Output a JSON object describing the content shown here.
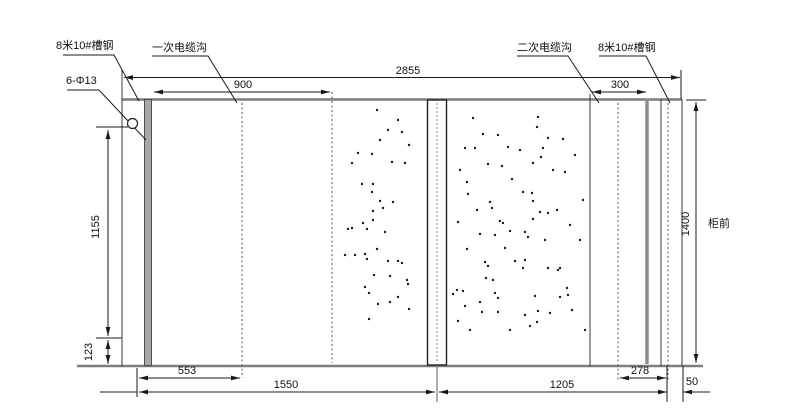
{
  "drawing": {
    "callouts": {
      "left_channel": "8米10#槽钢",
      "primary_cable_trench": "一次电缆沟",
      "secondary_cable_trench": "二次电缆沟",
      "right_channel": "8米10#槽钢",
      "bolt_holes": "6-Φ13",
      "cabinet_front": "柜前"
    },
    "dimensions": {
      "overall_width": "2855",
      "primary_trench_span": "900",
      "secondary_trench_span": "300",
      "left_height_upper": "1155",
      "left_height_lower": "123",
      "right_height": "1400",
      "bottom_left": "553",
      "bottom_mid": "1550",
      "bottom_right": "1205",
      "trench_offset": "278",
      "edge_offset": "50"
    },
    "colors": {
      "dimension_lines": "#1a1a1a",
      "foundation_outline": "#7d7d7d",
      "channel_steel_fill": "#a8a8a8",
      "background": "#ffffff"
    },
    "stipple_dots": [
      [
        377,
        110
      ],
      [
        388,
        130
      ],
      [
        402,
        132
      ],
      [
        380,
        140
      ],
      [
        358,
        153
      ],
      [
        372,
        154
      ],
      [
        392,
        162
      ],
      [
        405,
        163
      ],
      [
        362,
        184
      ],
      [
        373,
        184
      ],
      [
        372,
        192
      ],
      [
        380,
        201
      ],
      [
        393,
        202
      ],
      [
        383,
        208
      ],
      [
        373,
        211
      ],
      [
        373,
        220
      ],
      [
        363,
        223
      ],
      [
        352,
        228
      ],
      [
        367,
        229
      ],
      [
        385,
        232
      ],
      [
        377,
        249
      ],
      [
        355,
        255
      ],
      [
        365,
        254
      ],
      [
        367,
        259
      ],
      [
        388,
        261
      ],
      [
        398,
        261
      ],
      [
        402,
        263
      ],
      [
        390,
        276
      ],
      [
        374,
        275
      ],
      [
        407,
        280
      ],
      [
        365,
        287
      ],
      [
        408,
        284
      ],
      [
        369,
        293
      ],
      [
        398,
        297
      ],
      [
        378,
        304
      ],
      [
        390,
        302
      ],
      [
        409,
        309
      ],
      [
        369,
        319
      ],
      [
        348,
        229
      ],
      [
        352,
        163
      ],
      [
        345,
        255
      ],
      [
        409,
        145
      ],
      [
        398,
        120
      ],
      [
        473,
        118
      ],
      [
        538,
        117
      ],
      [
        537,
        127
      ],
      [
        483,
        134
      ],
      [
        498,
        135
      ],
      [
        548,
        138
      ],
      [
        563,
        139
      ],
      [
        465,
        148
      ],
      [
        475,
        148
      ],
      [
        508,
        147
      ],
      [
        543,
        148
      ],
      [
        533,
        163
      ],
      [
        541,
        157
      ],
      [
        488,
        164
      ],
      [
        502,
        166
      ],
      [
        553,
        170
      ],
      [
        565,
        172
      ],
      [
        467,
        182
      ],
      [
        512,
        179
      ],
      [
        523,
        192
      ],
      [
        532,
        193
      ],
      [
        468,
        194
      ],
      [
        533,
        201
      ],
      [
        490,
        202
      ],
      [
        477,
        210
      ],
      [
        492,
        208
      ],
      [
        540,
        212
      ],
      [
        548,
        213
      ],
      [
        557,
        210
      ],
      [
        500,
        221
      ],
      [
        458,
        222
      ],
      [
        503,
        223
      ],
      [
        533,
        219
      ],
      [
        480,
        234
      ],
      [
        495,
        235
      ],
      [
        510,
        231
      ],
      [
        525,
        232
      ],
      [
        528,
        237
      ],
      [
        545,
        240
      ],
      [
        467,
        249
      ],
      [
        505,
        248
      ],
      [
        515,
        261
      ],
      [
        525,
        260
      ],
      [
        523,
        268
      ],
      [
        548,
        268
      ],
      [
        558,
        270
      ],
      [
        560,
        268
      ],
      [
        485,
        262
      ],
      [
        488,
        266
      ],
      [
        486,
        278
      ],
      [
        493,
        280
      ],
      [
        457,
        290
      ],
      [
        463,
        291
      ],
      [
        495,
        293
      ],
      [
        498,
        298
      ],
      [
        480,
        302
      ],
      [
        453,
        294
      ],
      [
        465,
        306
      ],
      [
        482,
        312
      ],
      [
        498,
        312
      ],
      [
        535,
        296
      ],
      [
        538,
        311
      ],
      [
        550,
        313
      ],
      [
        560,
        297
      ],
      [
        567,
        288
      ],
      [
        568,
        295
      ],
      [
        537,
        322
      ],
      [
        530,
        326
      ],
      [
        458,
        321
      ],
      [
        575,
        155
      ],
      [
        580,
        240
      ],
      [
        572,
        310
      ],
      [
        583,
        200
      ],
      [
        460,
        170
      ],
      [
        520,
        150
      ],
      [
        570,
        225
      ],
      [
        585,
        330
      ],
      [
        470,
        330
      ],
      [
        510,
        330
      ],
      [
        525,
        315
      ]
    ]
  }
}
